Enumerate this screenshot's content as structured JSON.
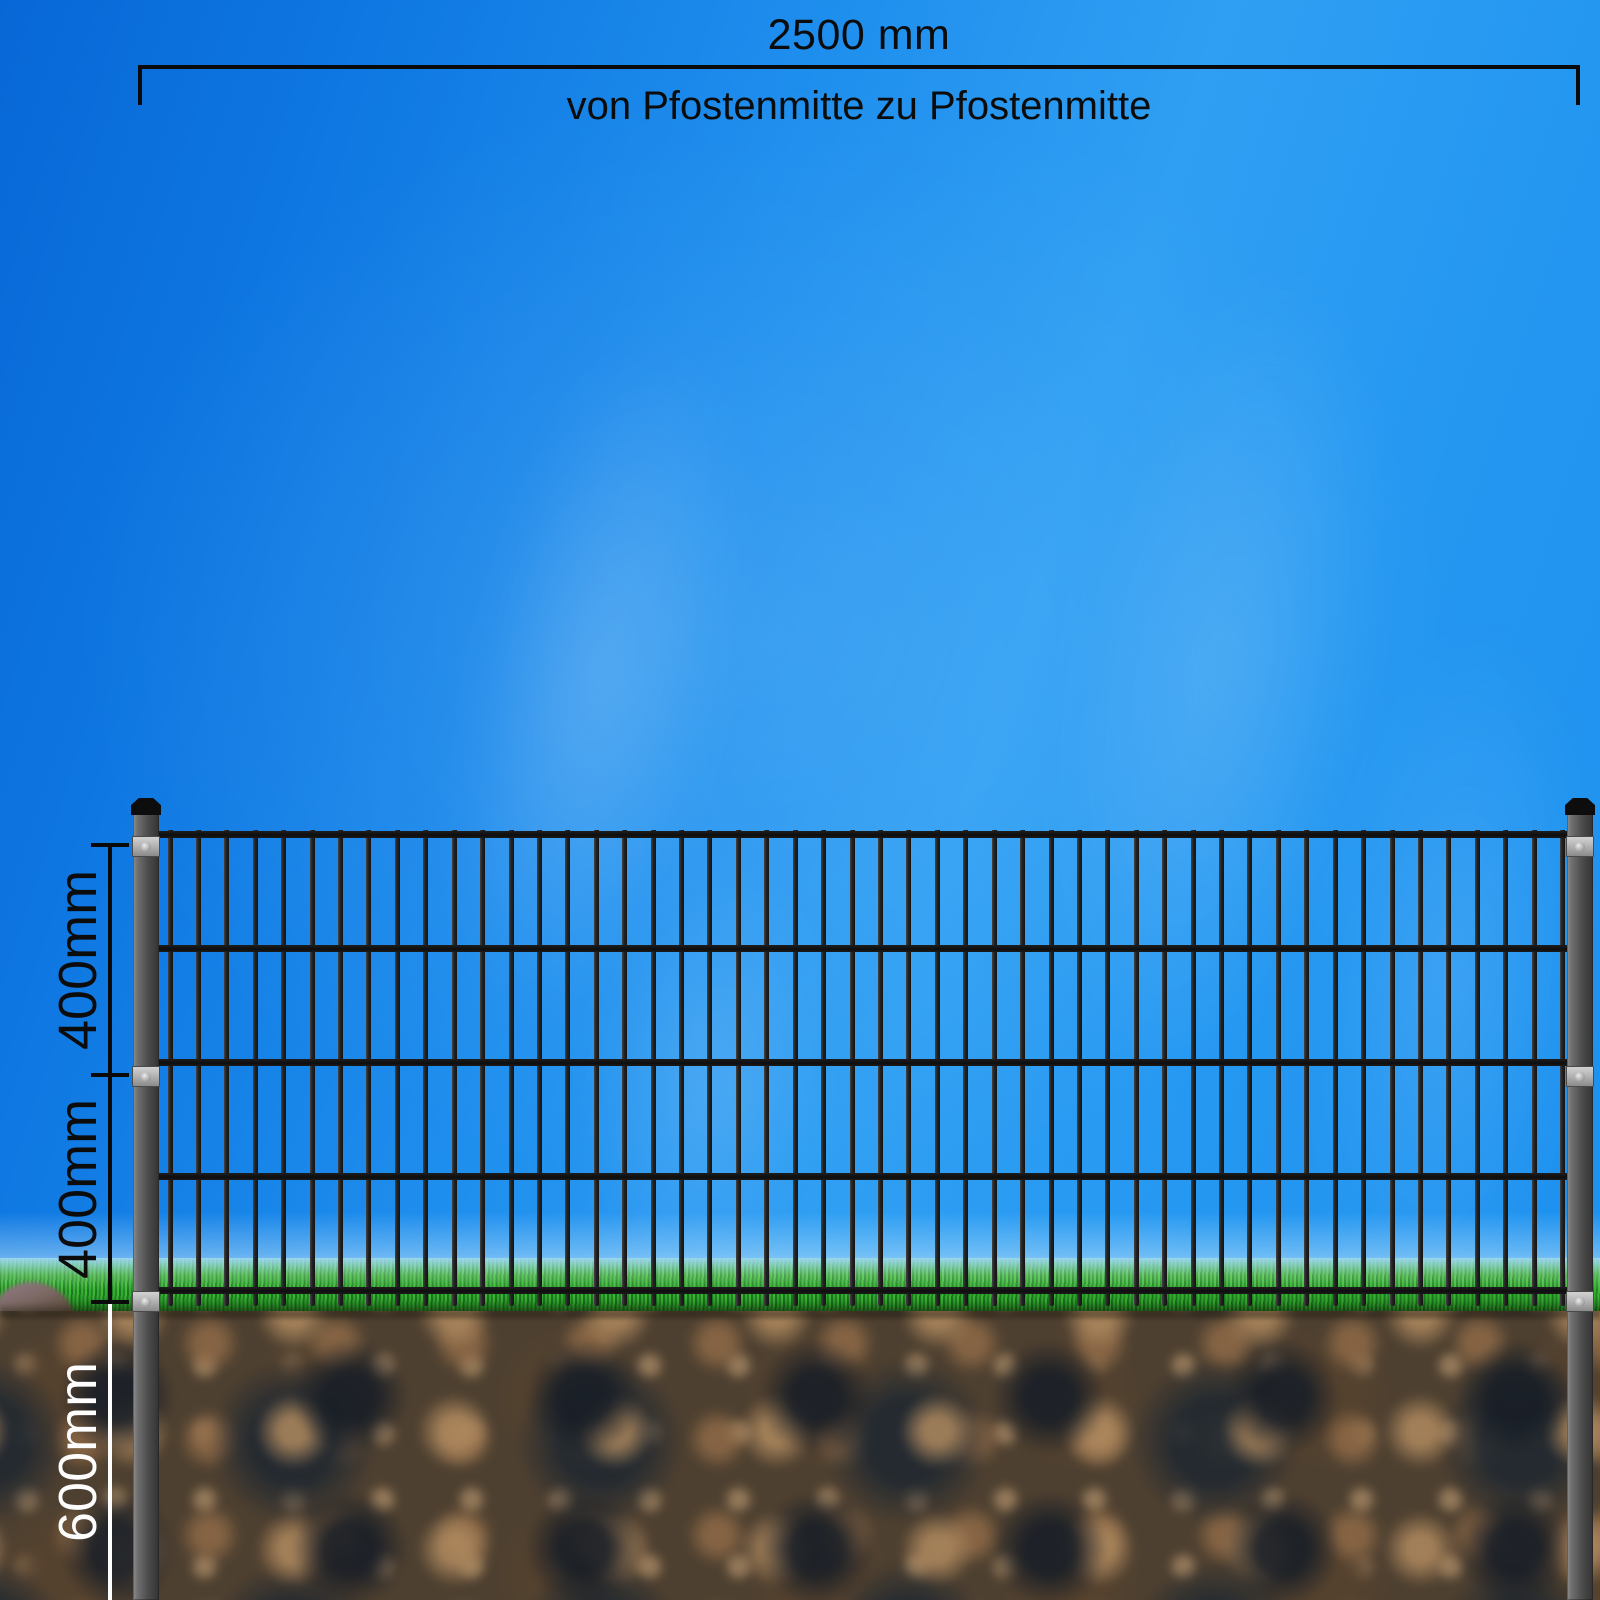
{
  "top_dimension": {
    "label": "2500 mm",
    "sublabel": "von Pfostenmitte zu Pfostenmitte"
  },
  "left_dimensions": {
    "upper_panel": "400mm",
    "lower_panel": "400mm",
    "post_depth": "600mm"
  },
  "fence": {
    "vertical_bar_count": 50,
    "horizontal_wire_count": 5,
    "post_count": 2,
    "clamps_per_post": 3,
    "colors": {
      "bar": "#1a1a1a",
      "wire": "#121212",
      "post_light": "#8d8d8d",
      "post_dark": "#333333",
      "post_cap": "#0d0d0d",
      "clamp": "#b5b5b5"
    }
  },
  "environment": {
    "sky_deep_blue": "#0767d6",
    "sky_bright_blue": "#2f9ff3",
    "grass_green": "#2ea52d",
    "soil_brown": "#4e4030",
    "rock_gray_purple": "#977b8c",
    "dimension_black": "#0a0a0a",
    "dimension_white": "#fdfdfd"
  }
}
